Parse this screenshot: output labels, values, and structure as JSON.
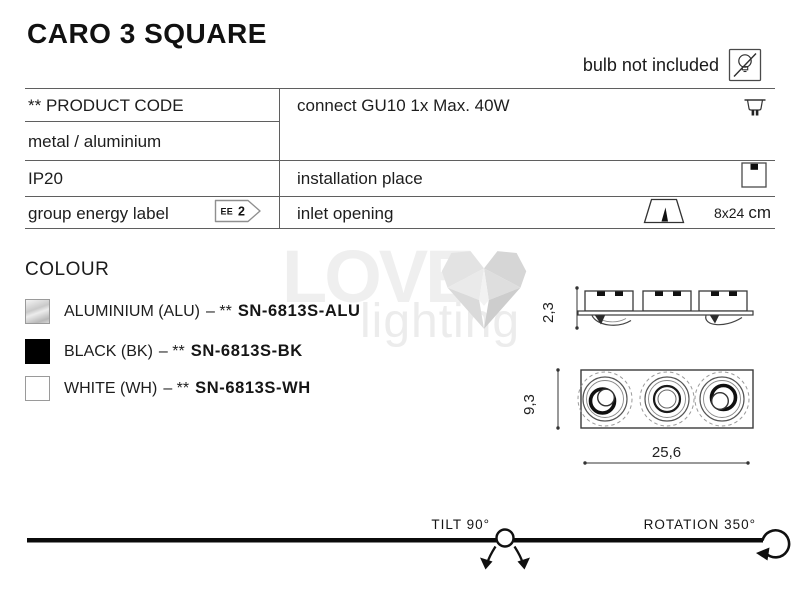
{
  "title": "CARO 3 SQUARE",
  "header": {
    "bulb_note": "bulb not included"
  },
  "spec_table": {
    "product_code": "** PRODUCT CODE",
    "material": "metal / aluminium",
    "ip_rating": "IP20",
    "energy_label": "group energy label",
    "energy_badge": {
      "label": "EE",
      "class": "2"
    },
    "connection": "connect GU10 1x Max. 40W",
    "installation": "installation place",
    "inlet": "inlet opening",
    "inlet_size": "8x24",
    "inlet_unit": "cm"
  },
  "colour_section": {
    "heading": "COLOUR",
    "separator": "– **",
    "items": [
      {
        "name": "ALUMINIUM (ALU)",
        "code": "SN-6813S-ALU",
        "swatch": "aluminium"
      },
      {
        "name": "BLACK (BK)",
        "code": "SN-6813S-BK",
        "swatch": "black"
      },
      {
        "name": "WHITE (WH)",
        "code": "SN-6813S-WH",
        "swatch": "white"
      }
    ]
  },
  "drawings": {
    "side_height": "2,3",
    "front_height": "9,3",
    "front_width": "25,6"
  },
  "footer": {
    "tilt": "TILT 90°",
    "rotation": "ROTATION 350°"
  },
  "watermark": {
    "word1": "LOVE",
    "word2": "lighting"
  },
  "icons": {
    "bulb": "bulb-crossed-square",
    "socket": "gu10-socket",
    "installation": "recessed-ceiling-square",
    "inlet": "cutout-trapezoid",
    "tilt": "tilt-swivel-arrows",
    "rotation": "rotation-loop-arrow"
  },
  "colors": {
    "text": "#1c1c1c",
    "table_line": "#5f5f5f",
    "drawing_stroke": "#3a3a3a",
    "footer_line": "#0b0b0b",
    "watermark_gray": "#ececec"
  }
}
